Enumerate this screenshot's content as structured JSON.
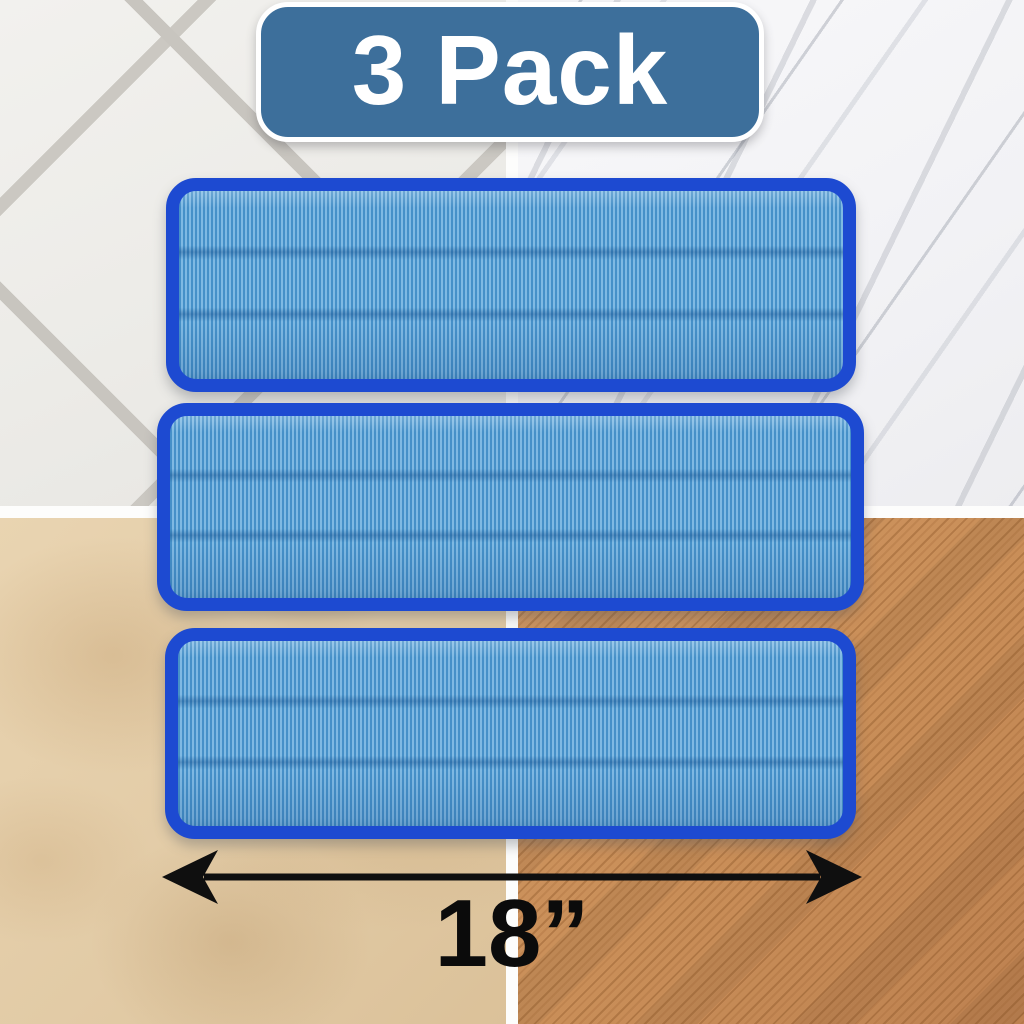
{
  "product_image": {
    "description": "3-pack of 18-inch blue microfiber mop pad refills displayed over four floor types",
    "badge": {
      "label": "3 Pack",
      "background_color": "#3d6f9b",
      "text_color": "#ffffff",
      "border_color": "#ffffff"
    },
    "dimension_annotation": {
      "label": "18”",
      "arrow_color": "#0f0f0f",
      "text_color": "#0b0b0b",
      "measures": "mop pad width"
    },
    "mop_pads": {
      "count": 3,
      "border_color": "#1d4ad1",
      "fabric_light_color": "#7fb9e3",
      "fabric_dark_color": "#4690c8",
      "seam_lines_per_pad": 2,
      "items": [
        {
          "name": "mop-pad-1"
        },
        {
          "name": "mop-pad-2"
        },
        {
          "name": "mop-pad-3"
        }
      ]
    },
    "floor_swatches": {
      "divider_color": "#fdfdfc",
      "top_left": {
        "material": "white diagonal ceramic tile",
        "base_color": "#ecebe7",
        "grout_color": "#c8c5bf"
      },
      "top_right": {
        "material": "white marble with gray veining",
        "base_color": "#f5f5f8",
        "vein_color": "#9aa0ac"
      },
      "bottom_left": {
        "material": "beige travertine stone",
        "base_color": "#e2cba6"
      },
      "bottom_right": {
        "material": "orange-brown wood plank",
        "base_color": "#c98e58"
      }
    }
  }
}
